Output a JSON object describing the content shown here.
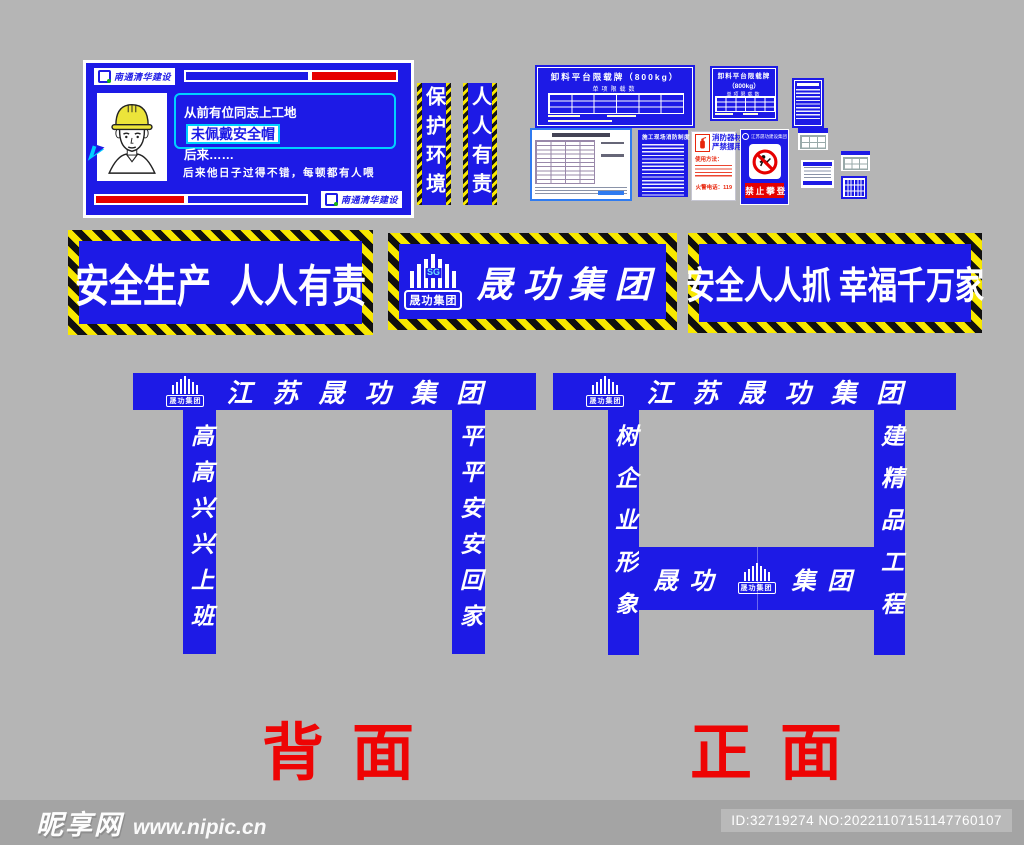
{
  "colors": {
    "accent_blue": "#1d1ae6",
    "hazard_yellow": "#f8e800",
    "alert_red": "#e60000",
    "bubble_cyan": "#00cfff",
    "canvas_gray": "#b5b5b5",
    "footer_gray": "#a4a4a4"
  },
  "helmet_sign": {
    "brand": "南通清华建设",
    "line1": "从前有位同志上工地",
    "highlight": "未佩戴安全帽",
    "line2": "后来……",
    "caption": "后来他日子过得不错，每顿都有人喂"
  },
  "vertical_banners": [
    {
      "text": "保护环境"
    },
    {
      "text": "人人有责"
    }
  ],
  "load_sign_a": {
    "title": "卸料平台限载牌（800kg）",
    "subtitle": "单项限载数"
  },
  "load_sign_b": {
    "line1": "卸料平台限载牌",
    "line2": "（800kg）",
    "subtitle": "单项限载数"
  },
  "fire_rules_sign": {
    "title": "施工现场消防制度"
  },
  "fire_equipment_sign": {
    "title_line1": "消防器材",
    "title_line2": "严禁挪用",
    "usage_label": "使用方法：",
    "phone_label": "火警电话：119"
  },
  "no_climbing_sign": {
    "company": "江苏晟功建设集团",
    "label": "禁止攀登"
  },
  "logo": {
    "sg": "SG",
    "name": "晟功集团"
  },
  "stripe_banners": {
    "left": "安全生产  人人有责",
    "center": "晟功集团",
    "right": "安全人人抓 幸福千万家"
  },
  "gates": {
    "header": "江苏晟功集团",
    "back": {
      "left_pillar": "高高兴兴上班",
      "right_pillar": "平平安安回家",
      "label": "背面"
    },
    "front": {
      "left_pillar": "树企业形象",
      "right_pillar": "建精品工程",
      "beam_left": "晟功",
      "beam_right": "集团",
      "label": "正面"
    }
  },
  "watermark": {
    "site_name": "昵享网",
    "site_url": "www.nipic.cn",
    "id_text": "ID:32719274 NO:20221107151147760107"
  }
}
